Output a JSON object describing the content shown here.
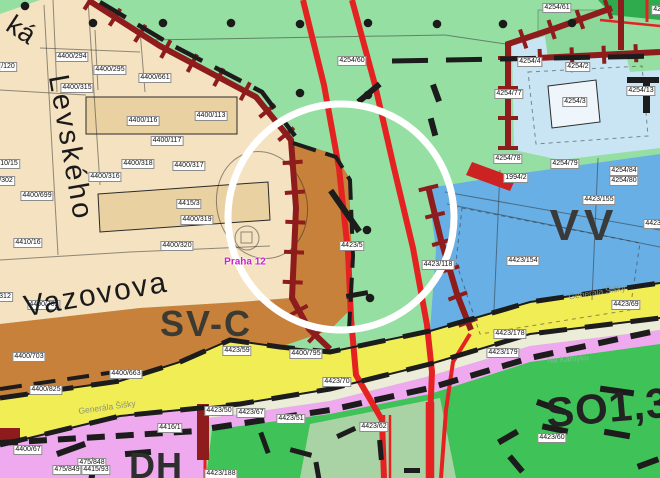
{
  "district": {
    "label": "Praha 12"
  },
  "zone_labels": [
    {
      "text": "SV-C",
      "x": 206,
      "y": 324,
      "size": 36,
      "rot": 0,
      "color": "#3b3b33",
      "ls": 2
    },
    {
      "text": "VV",
      "x": 584,
      "y": 226,
      "size": 44,
      "rot": 0,
      "color": "#3a3a3a",
      "ls": 5
    },
    {
      "text": "DH",
      "x": 156,
      "y": 466,
      "size": 36,
      "rot": 0,
      "color": "#2e2e2e",
      "ls": 1
    },
    {
      "text": "SO1,3",
      "x": 608,
      "y": 408,
      "size": 42,
      "rot": -5,
      "color": "#222222",
      "ls": 1
    }
  ],
  "street_labels": [
    {
      "text": "ká",
      "x": 21,
      "y": 30,
      "size": 27,
      "rot": 33,
      "ls": 0
    },
    {
      "text": "Levského",
      "x": 70,
      "y": 148,
      "size": 29,
      "rot": 80,
      "ls": 3
    },
    {
      "text": "Vazovova",
      "x": 96,
      "y": 295,
      "size": 30,
      "rot": -10,
      "ls": 2
    },
    {
      "text": "Generála Šišky",
      "x": 107,
      "y": 407,
      "size": 8.5,
      "rot": -8,
      "color": "#8e9178"
    },
    {
      "text": "Generála Šišky",
      "x": 597,
      "y": 292,
      "size": 8.5,
      "rot": -9,
      "color": "#8e9178"
    },
    {
      "text": "Na Kamýku",
      "x": 568,
      "y": 359,
      "size": 8,
      "rot": -4,
      "color": "#7cbf8e"
    }
  ],
  "parcel_labels": [
    {
      "text": "4400/294",
      "x": 72,
      "y": 57
    },
    {
      "text": "/120",
      "x": 8,
      "y": 67
    },
    {
      "text": "4400/295",
      "x": 110,
      "y": 70
    },
    {
      "text": "4400/315",
      "x": 77,
      "y": 88
    },
    {
      "text": "4400/661",
      "x": 155,
      "y": 78
    },
    {
      "text": "4400/116",
      "x": 143,
      "y": 121
    },
    {
      "text": "4400/113",
      "x": 211,
      "y": 116
    },
    {
      "text": "4400/117",
      "x": 167,
      "y": 141
    },
    {
      "text": "4400/318",
      "x": 138,
      "y": 164
    },
    {
      "text": "4400/316",
      "x": 105,
      "y": 177
    },
    {
      "text": "4400/317",
      "x": 189,
      "y": 166
    },
    {
      "text": "10/15",
      "x": 9,
      "y": 164
    },
    {
      "text": "/302",
      "x": 6,
      "y": 181
    },
    {
      "text": "4400/699",
      "x": 37,
      "y": 196
    },
    {
      "text": "4415/3",
      "x": 189,
      "y": 204
    },
    {
      "text": "4400/319",
      "x": 197,
      "y": 220
    },
    {
      "text": "4410/16",
      "x": 28,
      "y": 243
    },
    {
      "text": "4400/320",
      "x": 177,
      "y": 246
    },
    {
      "text": "312",
      "x": 5,
      "y": 297
    },
    {
      "text": "4400/702",
      "x": 44,
      "y": 305
    },
    {
      "text": "4400/703",
      "x": 29,
      "y": 357
    },
    {
      "text": "4400/825",
      "x": 46,
      "y": 390
    },
    {
      "text": "4400/663",
      "x": 126,
      "y": 374
    },
    {
      "text": "4400/67",
      "x": 28,
      "y": 450
    },
    {
      "text": "475/848",
      "x": 92,
      "y": 463
    },
    {
      "text": "475/849",
      "x": 67,
      "y": 470
    },
    {
      "text": "4415/93",
      "x": 96,
      "y": 470
    },
    {
      "text": "4416/1",
      "x": 170,
      "y": 428
    },
    {
      "text": "4423/188",
      "x": 221,
      "y": 474
    },
    {
      "text": "4254/60",
      "x": 352,
      "y": 61
    },
    {
      "text": "4254/61",
      "x": 557,
      "y": 8
    },
    {
      "text": "425/4",
      "x": 662,
      "y": 10
    },
    {
      "text": "4254/4",
      "x": 530,
      "y": 62
    },
    {
      "text": "4254/2",
      "x": 578,
      "y": 67
    },
    {
      "text": "4254/77",
      "x": 509,
      "y": 94
    },
    {
      "text": "4254/3",
      "x": 575,
      "y": 102
    },
    {
      "text": "4254/13",
      "x": 641,
      "y": 91
    },
    {
      "text": "4254/78",
      "x": 508,
      "y": 159
    },
    {
      "text": "4254/79",
      "x": 565,
      "y": 164
    },
    {
      "text": "4254/84",
      "x": 624,
      "y": 171
    },
    {
      "text": "4254/80",
      "x": 624,
      "y": 181
    },
    {
      "text": "1994/2",
      "x": 516,
      "y": 178
    },
    {
      "text": "4423/155",
      "x": 599,
      "y": 200
    },
    {
      "text": "4423/118",
      "x": 438,
      "y": 265
    },
    {
      "text": "4423/12",
      "x": 658,
      "y": 224
    },
    {
      "text": "4423/154",
      "x": 523,
      "y": 261
    },
    {
      "text": "4423/5",
      "x": 352,
      "y": 246
    },
    {
      "text": "4400/795",
      "x": 306,
      "y": 354
    },
    {
      "text": "4423/59",
      "x": 237,
      "y": 351
    },
    {
      "text": "4423/70",
      "x": 337,
      "y": 382
    },
    {
      "text": "4423/50",
      "x": 219,
      "y": 411
    },
    {
      "text": "4423/67",
      "x": 251,
      "y": 413
    },
    {
      "text": "4423/51",
      "x": 291,
      "y": 419
    },
    {
      "text": "4423/62",
      "x": 374,
      "y": 427
    },
    {
      "text": "4423/69",
      "x": 626,
      "y": 305
    },
    {
      "text": "4423/178",
      "x": 510,
      "y": 334
    },
    {
      "text": "4423/179",
      "x": 503,
      "y": 353
    },
    {
      "text": "4423/60",
      "x": 552,
      "y": 438
    }
  ],
  "colors": {
    "light_green_zone": "#95dfa3",
    "dark_green_zone": "#2fab4d",
    "residential_beige": "#f4e2c1",
    "mixed_orange_svc": "#c8813a",
    "pale_blue_zone": "#c9e4f3",
    "public_blue_vv": "#68afe5",
    "road_yellow": "#f1ee55",
    "strip_pink_dh": "#efa9ef",
    "bright_green_so13": "#3fc258",
    "sage_green": "#a9d3a4",
    "red_line": "#e52222",
    "maroon_wall": "#8e1c1c",
    "district_magenta": "#c724c7",
    "highlight_circle": "#ffffff"
  }
}
